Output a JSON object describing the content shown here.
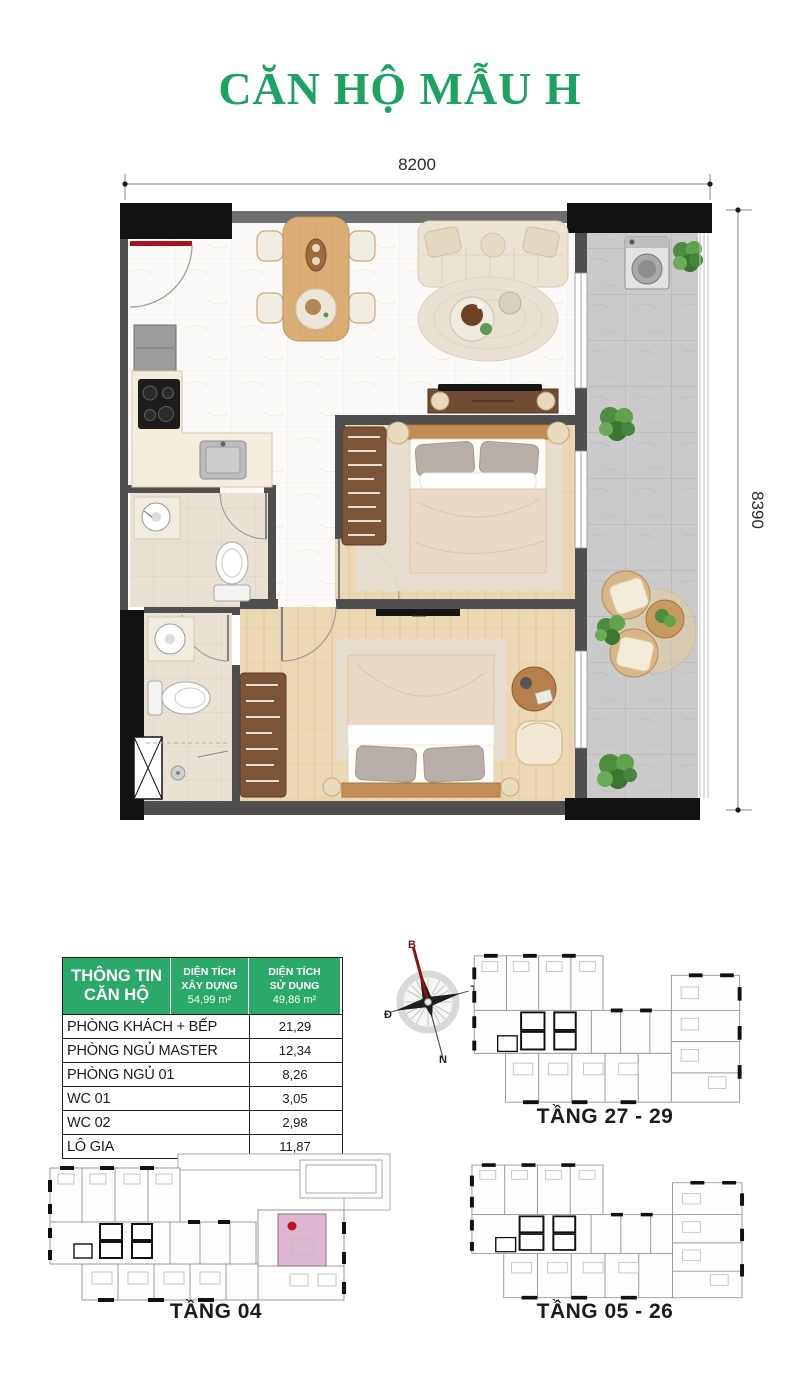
{
  "title": "CĂN HỘ MẪU H",
  "dimensions": {
    "width": "8200",
    "height": "8390"
  },
  "info_table": {
    "header": {
      "title": "THÔNG TIN CĂN HỘ",
      "col2": {
        "line1": "DIỆN TÍCH",
        "line2": "XÂY DỰNG",
        "value": "54,99 m²"
      },
      "col3": {
        "line1": "DIỆN TÍCH",
        "line2": "SỬ DỤNG",
        "value": "49,86 m²"
      }
    },
    "rows": [
      {
        "label": "PHÒNG KHÁCH + BẾP",
        "value": "21,29"
      },
      {
        "label": "PHÒNG NGỦ MASTER",
        "value": "12,34"
      },
      {
        "label": "PHÒNG NGỦ 01",
        "value": "8,26"
      },
      {
        "label": "WC 01",
        "value": "3,05"
      },
      {
        "label": "WC 02",
        "value": "2,98"
      },
      {
        "label": "LÔ GIA",
        "value": "11,87"
      }
    ]
  },
  "compass": {
    "top": "B",
    "right": "T",
    "left": "Đ",
    "bottom": "N"
  },
  "key_plans": {
    "plan_27_29": "TẦNG 27 - 29",
    "plan_04": "TẦNG 04",
    "plan_05_26": "TẦNG 05 - 26"
  },
  "colors": {
    "accent_green": "#1ca262",
    "table_header_green": "#2aa968",
    "highlight_pink": "#dcb6cf",
    "marker_red": "#c0131c"
  }
}
